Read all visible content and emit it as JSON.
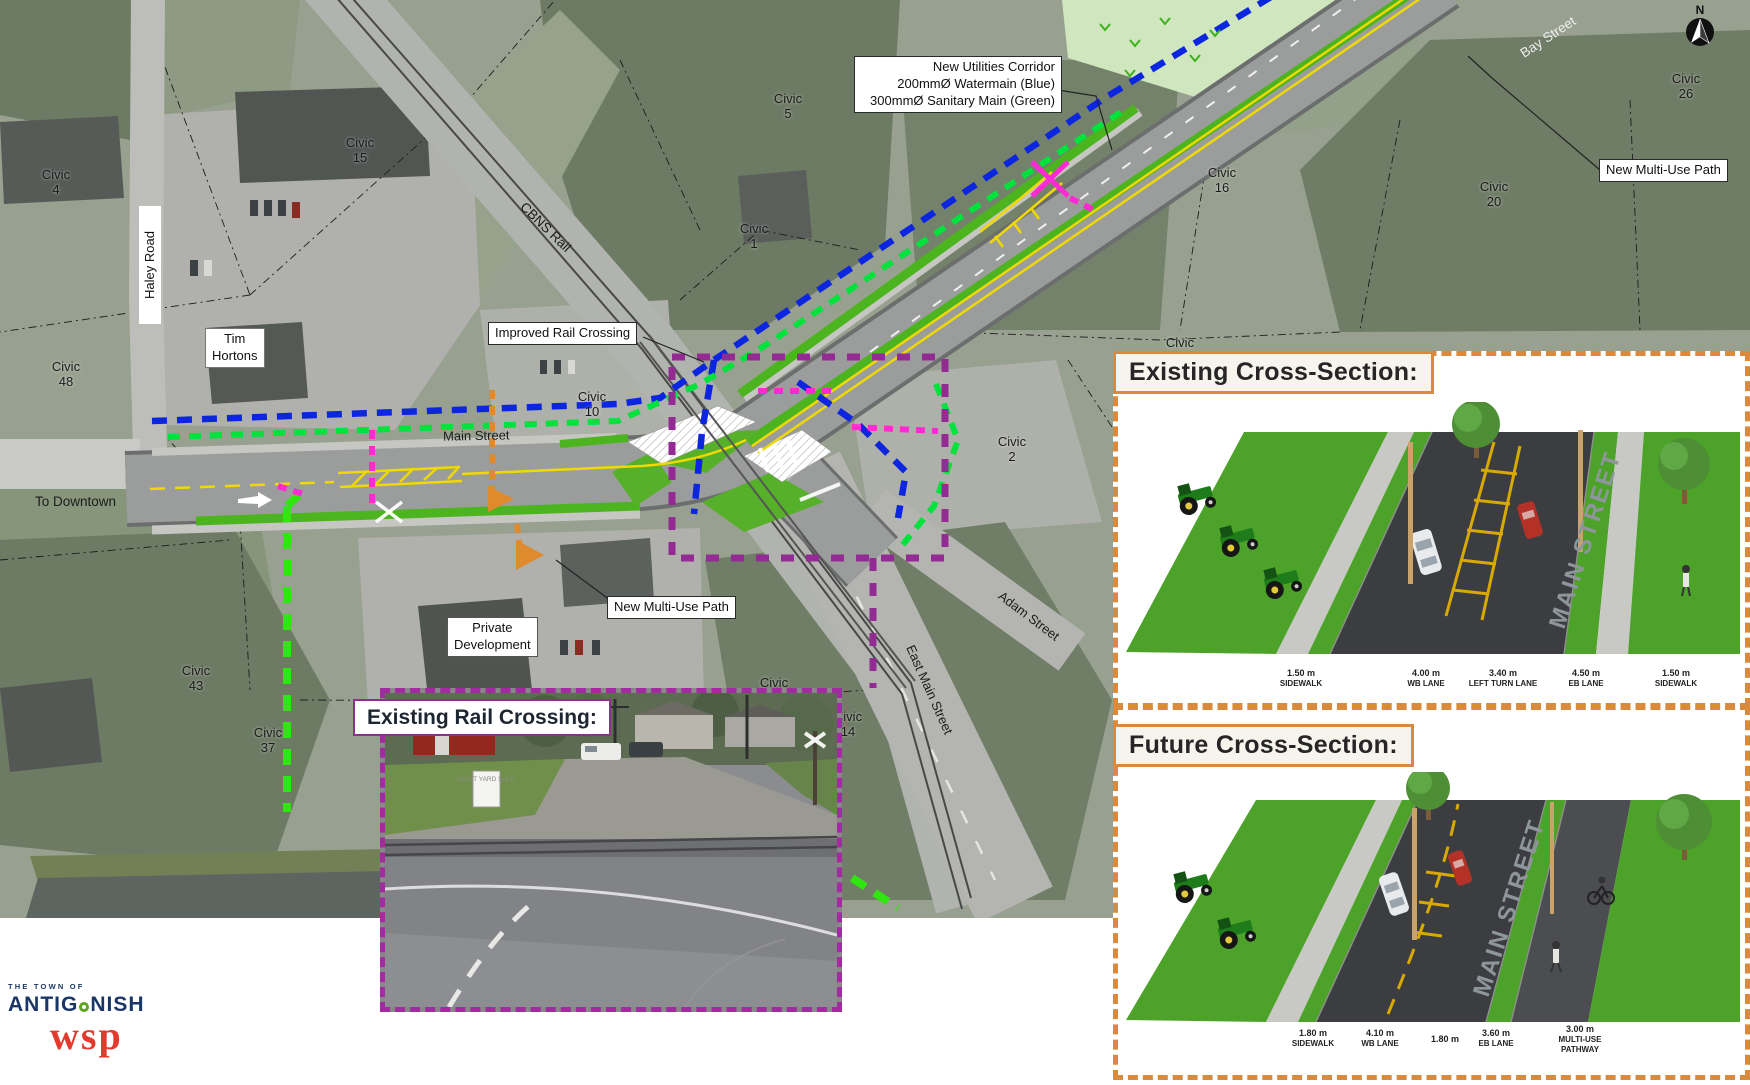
{
  "map": {
    "street_labels": {
      "haley_road": "Haley Road",
      "main_street": "Main Street",
      "to_downtown": "To Downtown",
      "cbns_rail": "CBNS Rail",
      "bay_street": "Bay Street",
      "adam_street": "Adam Street",
      "east_main_street": "East Main Street"
    },
    "callouts": {
      "new_utilities_corridor": "New Utilities Corridor\n200mmØ Watermain (Blue)\n300mmØ Sanitary Main (Green)",
      "improved_rail_crossing": "Improved Rail Crossing",
      "new_multi_use_path_south": "New Multi-Use Path",
      "new_multi_use_path_northeast": "New Multi-Use Path",
      "private_development": "Private\nDevelopment",
      "tim_hortons": "Tim\nHortons"
    },
    "civic": {
      "c4": "Civic\n4",
      "c48": "Civic\n48",
      "c15": "Civic\n15",
      "c5": "Civic\n5",
      "c1": "Civic\n1",
      "c10": "Civic\n10",
      "c2": "Civic\n2",
      "c43": "Civic\n43",
      "c37": "Civic\n37",
      "c12": "Civic\n12",
      "c14": "Civic\n14",
      "c16": "Civic\n16",
      "c20": "Civic\n20",
      "c26": "Civic\n26",
      "partial": "Civic"
    },
    "compass_n": "N"
  },
  "photo_inset": {
    "title": "Existing Rail Crossing:",
    "sign": "GIANT\nYARD\nSALE"
  },
  "sections": {
    "existing": {
      "title": "Existing Cross-Section:",
      "street_name": "MAIN STREET",
      "dims": [
        {
          "value": "1.50 m",
          "label": "SIDEWALK"
        },
        {
          "value": "4.00 m",
          "label": "WB LANE"
        },
        {
          "value": "3.40 m",
          "label": "LEFT TURN LANE"
        },
        {
          "value": "4.50 m",
          "label": "EB LANE"
        },
        {
          "value": "1.50 m",
          "label": "SIDEWALK"
        }
      ]
    },
    "future": {
      "title": "Future Cross-Section:",
      "street_name": "MAIN STREET",
      "dims": [
        {
          "value": "1.80 m",
          "label": "SIDEWALK"
        },
        {
          "value": "4.10 m",
          "label": "WB LANE"
        },
        {
          "value": "1.80 m",
          "label": ""
        },
        {
          "value": "3.60 m",
          "label": "EB LANE"
        },
        {
          "value": "3.00 m",
          "label": "MULTI-USE\nPATHWAY"
        }
      ]
    }
  },
  "branding": {
    "town_prefix": "THE TOWN OF",
    "town_name_left": "ANTIG",
    "town_name_right": "NISH",
    "wsp": "wsp"
  },
  "legend_colors": {
    "watermain_blue": "#0c25e0",
    "sanitary_green": "#00e23c",
    "multi_use_path_green": "#2fe60f",
    "crossing_magenta": "#ff2ad4",
    "study_area_purple": "#942a94",
    "panel_border_orange": "#d98a3c",
    "photo_border_purple": "#a22ba2"
  }
}
